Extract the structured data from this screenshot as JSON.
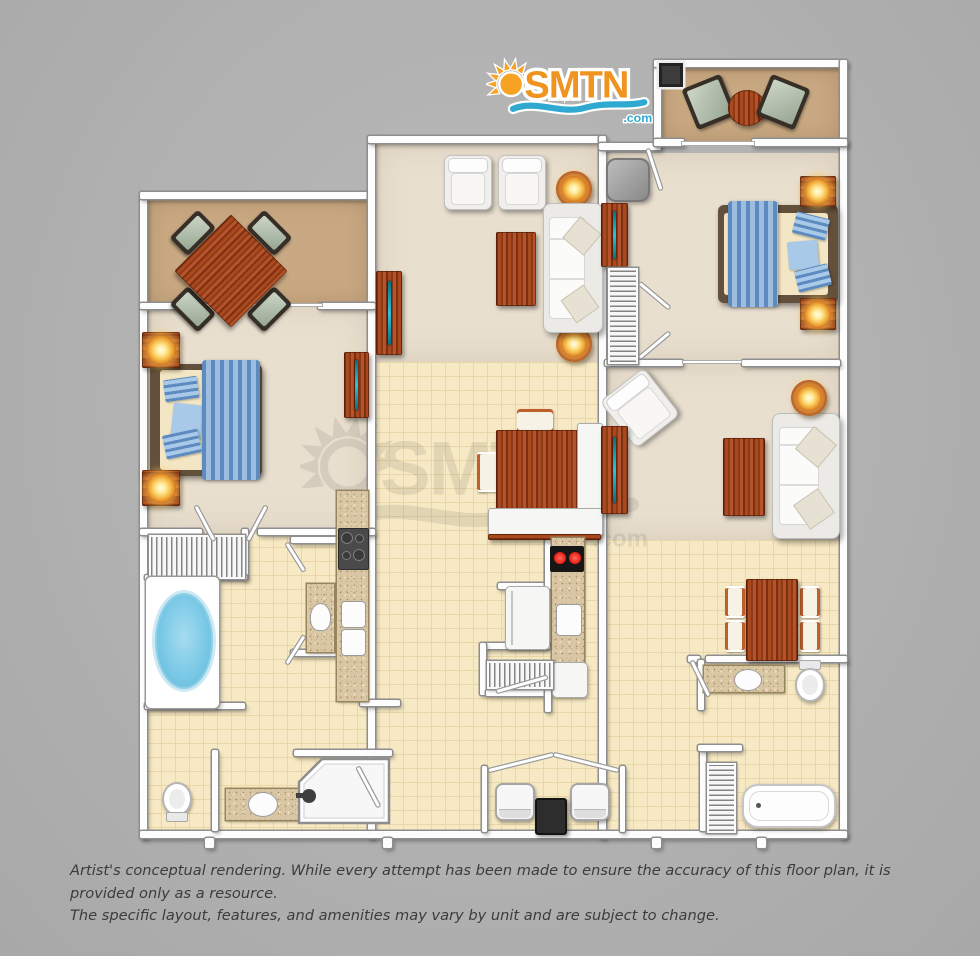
{
  "logo": {
    "name": "SMTN",
    "tld": ".com"
  },
  "watermark": {
    "name": "SMTN",
    "tld": ".com"
  },
  "disclaimer": {
    "line1": "Artist's conceptual rendering. While every attempt has been made to ensure the accuracy of this floor plan, it is provided only as a resource.",
    "line2": "The specific layout, features, and amenities may vary by unit and are subject to change."
  },
  "palette": {
    "background": "#b3b3b3",
    "wall": "#fdfdfd",
    "wall_outline": "#8e8e8e",
    "tile_floor": "#f7e9c3",
    "carpet": "#e9dfcf",
    "dining_carpet": "#c9a983",
    "granite": "#d9c6a4",
    "wood": "#9c4420",
    "water_blue": "#6cc0e4",
    "bed_blue": "#5d8bbf",
    "lamp_glow": "#f2a93b",
    "logo_orange": "#f0931f",
    "logo_blue": "#2fa9cf",
    "burner_red": "#e41c0f",
    "tv_teal": "#2ec3da"
  },
  "floor_plan": {
    "units": [
      {
        "id": "left-unit",
        "rooms": [
          "dining-room",
          "bedroom",
          "garden-tub-bathroom",
          "galley-kitchen",
          "bathroom-with-shower"
        ]
      },
      {
        "id": "center-unit",
        "rooms": [
          "living-room",
          "dining-area",
          "kitchen",
          "laundry-closet"
        ]
      },
      {
        "id": "right-unit",
        "rooms": [
          "balcony",
          "bedroom",
          "living-room",
          "dining-area",
          "bathroom-with-tub"
        ]
      }
    ],
    "furniture": [
      "dining-table",
      "dining-chair",
      "bed",
      "nightstand-with-lamp",
      "tv-console",
      "sofa",
      "armchair",
      "coffee-table",
      "round-lamp-table",
      "garden-tub",
      "bathtub",
      "shower",
      "toilet",
      "vanity-sink",
      "kitchen-sink",
      "gas-cooktop",
      "electric-stove",
      "refrigerator",
      "dishwasher",
      "washer",
      "dryer",
      "water-heater",
      "louvered-closet",
      "patio-chair",
      "patio-table",
      "grill",
      "gray-ottoman"
    ]
  }
}
